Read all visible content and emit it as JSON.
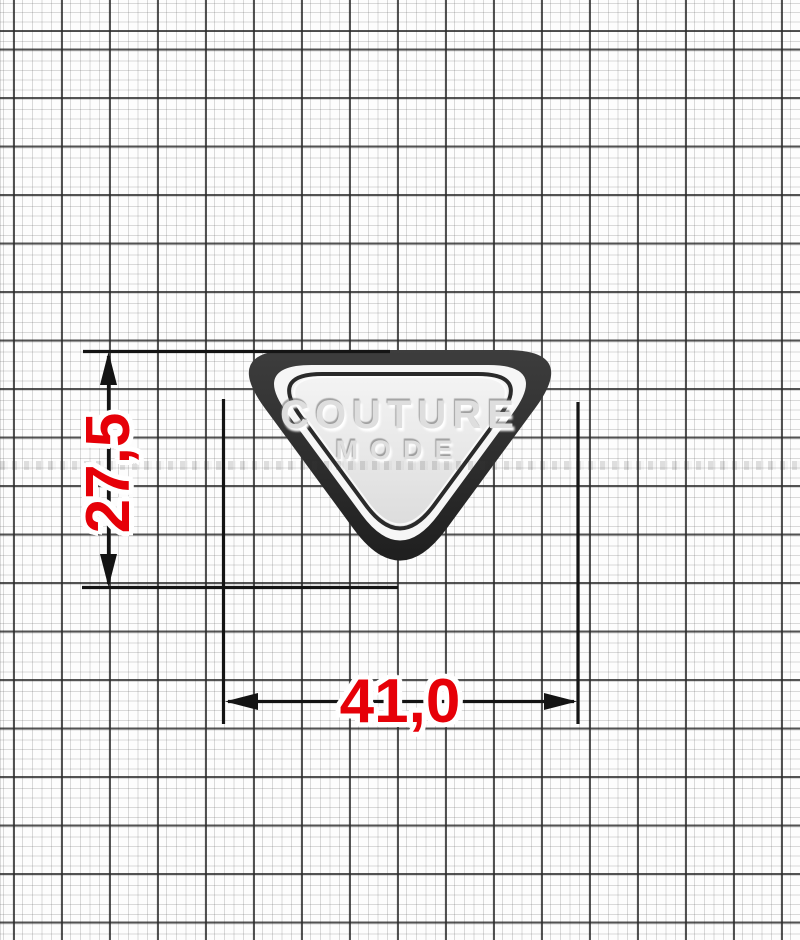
{
  "badge": {
    "line1": "COUTURE",
    "line2": "MODE"
  },
  "dimensions": {
    "height_label": "27,5",
    "width_label": "41,0"
  },
  "colors": {
    "dimension_text": "#e60008",
    "dimension_lines": "#141414",
    "badge_rim_top": "#3d3d3d",
    "badge_rim_bottom": "#1f1f1f",
    "badge_ring": "#f6f6f6",
    "badge_inner_line": "#2a2a2a",
    "badge_face_light": "#f4f4f4",
    "badge_face_dark": "#dcdcdc",
    "emboss_text": "#dedede",
    "paper": "#fdfdfd",
    "grid_minor": "#c9c9c9",
    "grid_major": "#282828"
  }
}
